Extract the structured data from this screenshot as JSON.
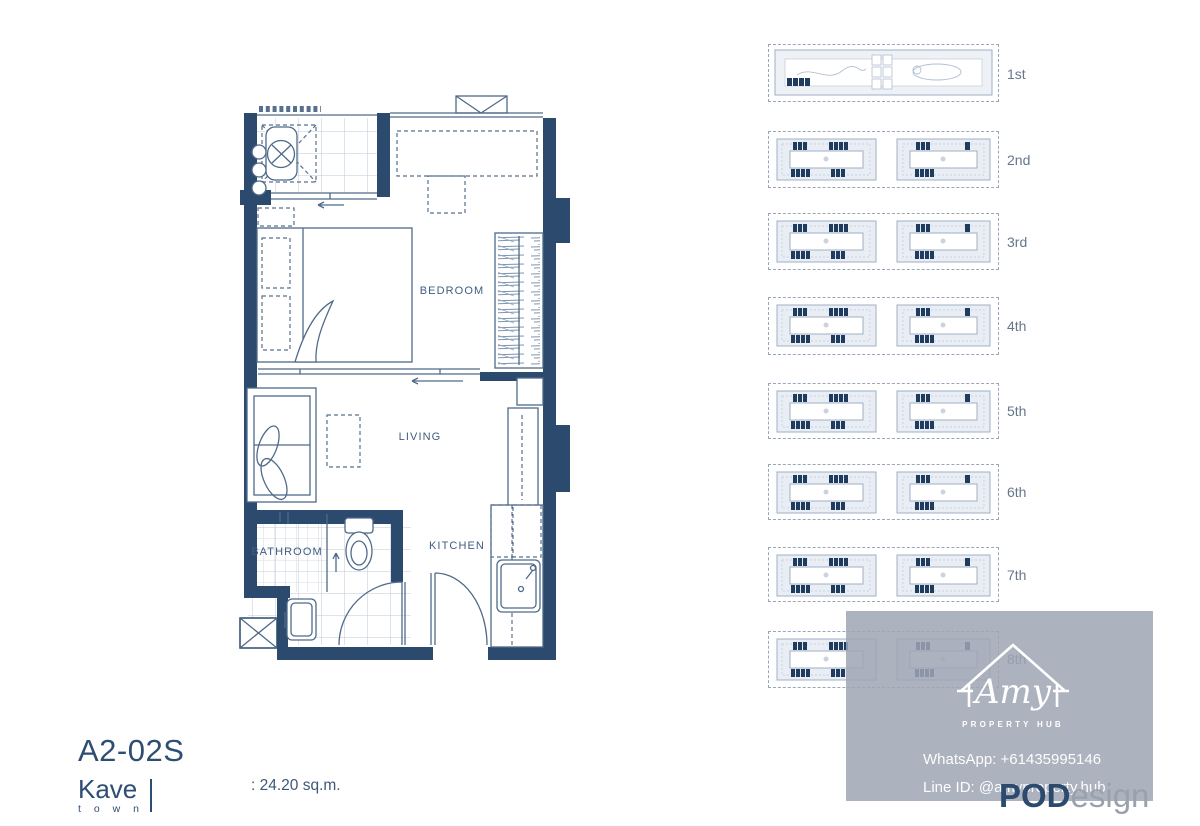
{
  "unit_plan": {
    "rooms": {
      "bedroom": "BEDROOM",
      "living": "LIVING",
      "kitchen": "KITCHEN",
      "bathroom": "BATHROOM"
    },
    "wall_color": "#2b4a6d"
  },
  "title_block": {
    "unit_code": "A2-02S",
    "brand_name": "Kave",
    "brand_sub": "t o w n",
    "area_label": ": 24.20 sq.m."
  },
  "floor_key": {
    "floors": [
      {
        "label": "1st"
      },
      {
        "label": "2nd"
      },
      {
        "label": "3rd"
      },
      {
        "label": "4th"
      },
      {
        "label": "5th"
      },
      {
        "label": "6th"
      },
      {
        "label": "7th"
      },
      {
        "label": "8th"
      }
    ],
    "highlight_color": "#1f3c5e",
    "outline_color": "#9fb0c6"
  },
  "watermark": {
    "logo_name": "Amy",
    "logo_sub": "PROPERTY HUB",
    "whatsapp": "WhatsApp: +61435995146",
    "line_id": "Line ID: @amyproperty.hub",
    "brand_bold": "POD",
    "brand_light": "esign"
  }
}
